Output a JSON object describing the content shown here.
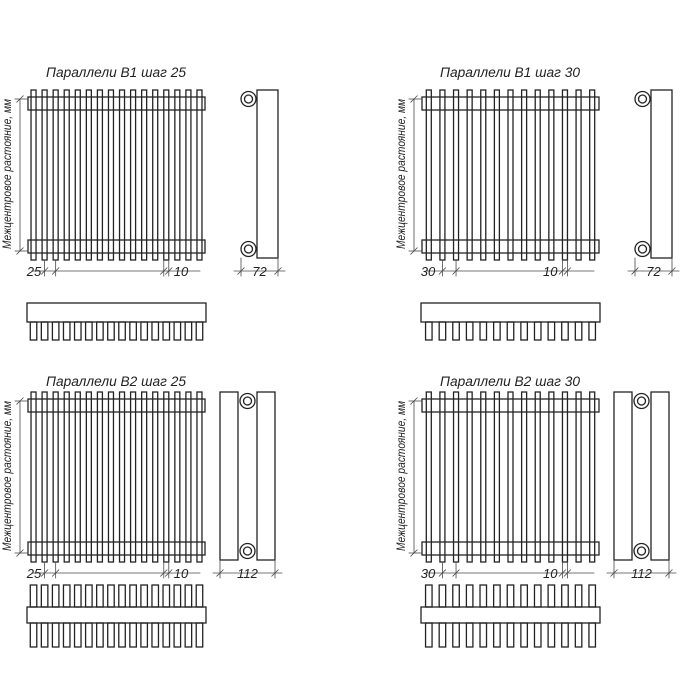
{
  "drawing": {
    "background": "#ffffff",
    "line_color": "#232323",
    "dimension_line_color": "#4a4a4a",
    "sheet_description": "Радиаторы Параллели — габаритные чертежи",
    "quadrants": [
      {
        "id": "b1-step-25",
        "title": "Параллели В1 шаг 25",
        "vertical_label": "Межцентровое растояние, мм",
        "front_view": {
          "tube_count": 16,
          "step_mm": "25",
          "tube_width_mm": "10"
        },
        "side_view": {
          "columns": 1,
          "depth_mm": "72"
        },
        "top_view": {
          "tooth_count": 16,
          "tooth_sides": "bottom"
        }
      },
      {
        "id": "b1-step-30",
        "title": "Параллели В1 шаг 30",
        "vertical_label": "Межцентровое растояние, мм",
        "front_view": {
          "tube_count": 13,
          "step_mm": "30",
          "tube_width_mm": "10"
        },
        "side_view": {
          "columns": 1,
          "depth_mm": "72"
        },
        "top_view": {
          "tooth_count": 13,
          "tooth_sides": "bottom"
        }
      },
      {
        "id": "b2-step-25",
        "title": "Параллели В2 шаг 25",
        "vertical_label": "Межцентровое растояние, мм",
        "front_view": {
          "tube_count": 16,
          "step_mm": "25",
          "tube_width_mm": "10"
        },
        "side_view": {
          "columns": 2,
          "depth_mm": "112"
        },
        "top_view": {
          "tooth_count": 16,
          "tooth_sides": "both"
        }
      },
      {
        "id": "b2-step-30",
        "title": "Параллели В2 шаг 30",
        "vertical_label": "Межцентровое растояние, мм",
        "front_view": {
          "tube_count": 13,
          "step_mm": "30",
          "tube_width_mm": "10"
        },
        "side_view": {
          "columns": 2,
          "depth_mm": "112"
        },
        "top_view": {
          "tooth_count": 13,
          "tooth_sides": "both"
        }
      }
    ]
  }
}
